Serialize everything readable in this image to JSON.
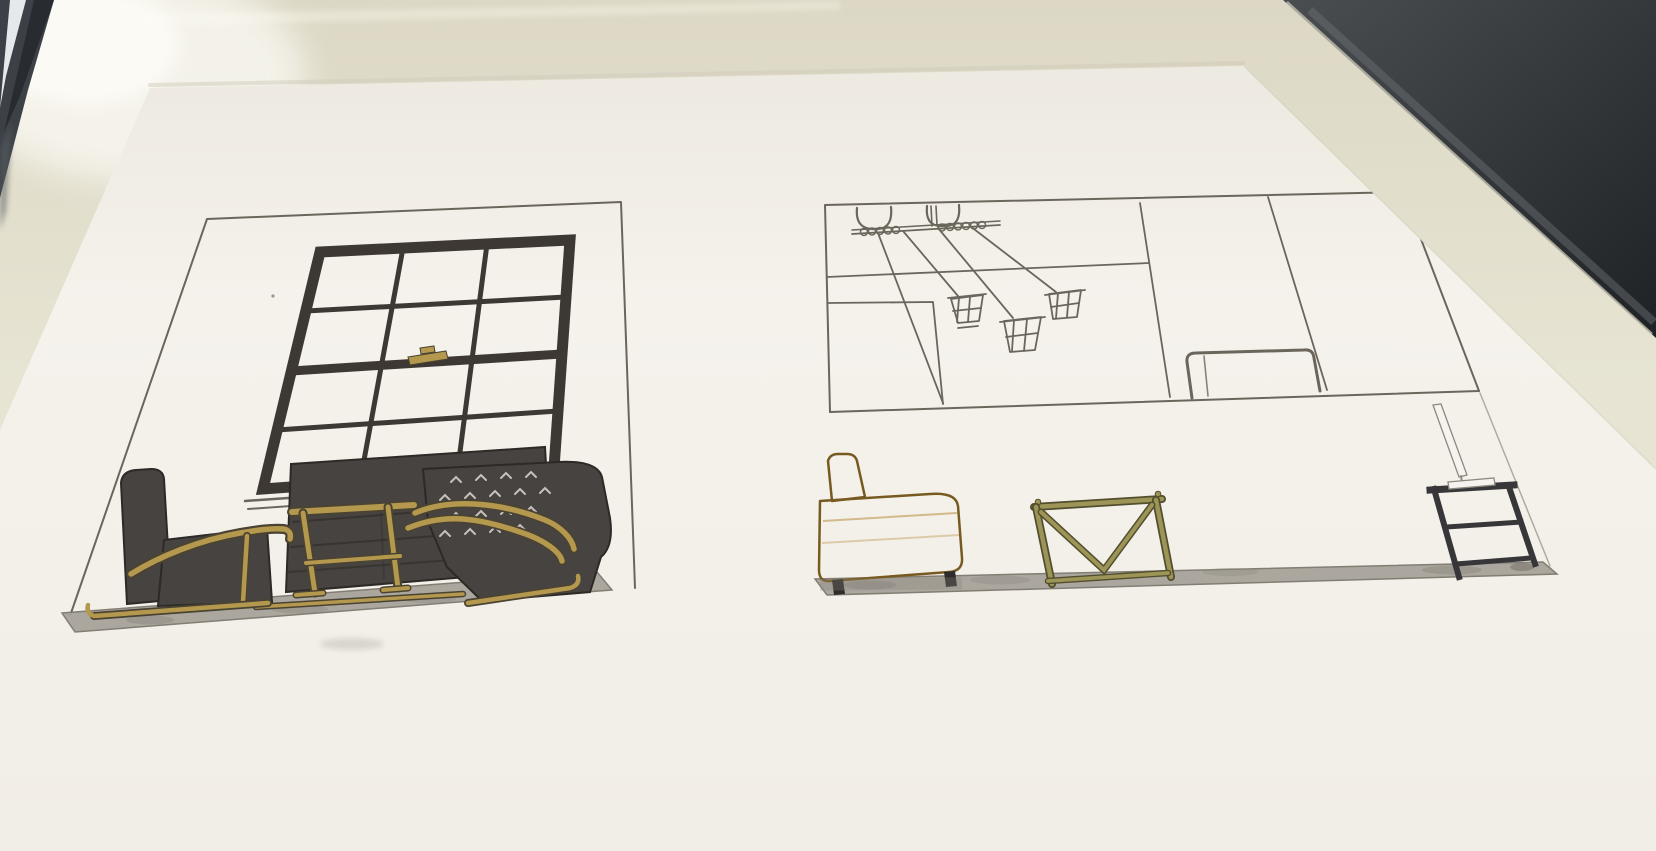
{
  "image": {
    "kind": "photograph",
    "subject": "Two hand-drawn interior design elevation sketches in marker and pen on a white sheet of paper, photographed at an angle on a glossy cream table",
    "left_sketch": {
      "label": "window-wall elevation",
      "elements": [
        "thin pencil wall outline",
        "large window with dark charcoal frame and 12 panes (3 columns x 4 rows)",
        "brass sash latch on the meeting rail",
        "double pencil sill line",
        "charcoal sofa with seat seams",
        "left armchair with brass bentwood arm and sled runner",
        "right armchair with diamond-tufted back and two brass bentwood arms",
        "brass side table with H-stretcher",
        "grey marker floor band with blotches"
      ]
    },
    "right_sketch": {
      "label": "storage-wall elevation",
      "elements": [
        "pencil wall outline divided into panels",
        "upper horizontal panel line",
        "small square panel at lower left",
        "two vertical panel dividers",
        "rounded headboard-like outline between dividers",
        "ceiling rail with hanging U-brackets and coiled cords",
        "three caged pendant lampshades on dropped cords",
        "mustard-yellow sofa in profile with tilted headrest and dark feet",
        "olive-brass console table with V-brace and bottom stretcher",
        "black two-shelf metal side table",
        "slim uncoloured task lamp on the side table",
        "grey marker floor band"
      ]
    },
    "surroundings": [
      "cream glossy tabletop",
      "white window reflection at top left",
      "chrome object in extreme top-left corner",
      "dark room corner beyond table edge at top right"
    ]
  },
  "colors": {
    "table": "#e7e4d3",
    "tableTop": "#dcd8c5",
    "paper": "#f5f2ec",
    "paperShadow": "#cfcaba",
    "pencil": "#6b665c",
    "frameDark": "#3d3833",
    "furnitureDark": "#474340",
    "seamDark": "#33302c",
    "gold": "#b3984d",
    "goldDark": "#4a4333",
    "olive": "#9c9557",
    "oliveDark": "#524e2e",
    "mustard": "#e2a84e",
    "mustardOutline": "#775a1f",
    "floorGray": "#a8a49a",
    "floorDark": "#8c887d",
    "tuft": "#c6c2ba",
    "legDark": "#2e2c2a",
    "steel": "#37373a",
    "chrome": "#3c4147",
    "chromeHighlight": "#eef2f4",
    "darkCorner1": "#4a4e51",
    "darkCorner2": "#1f2225",
    "highlight": "#fdfcf7",
    "lampBody": "#f6f3ee",
    "lampLine": "#8d897f"
  }
}
